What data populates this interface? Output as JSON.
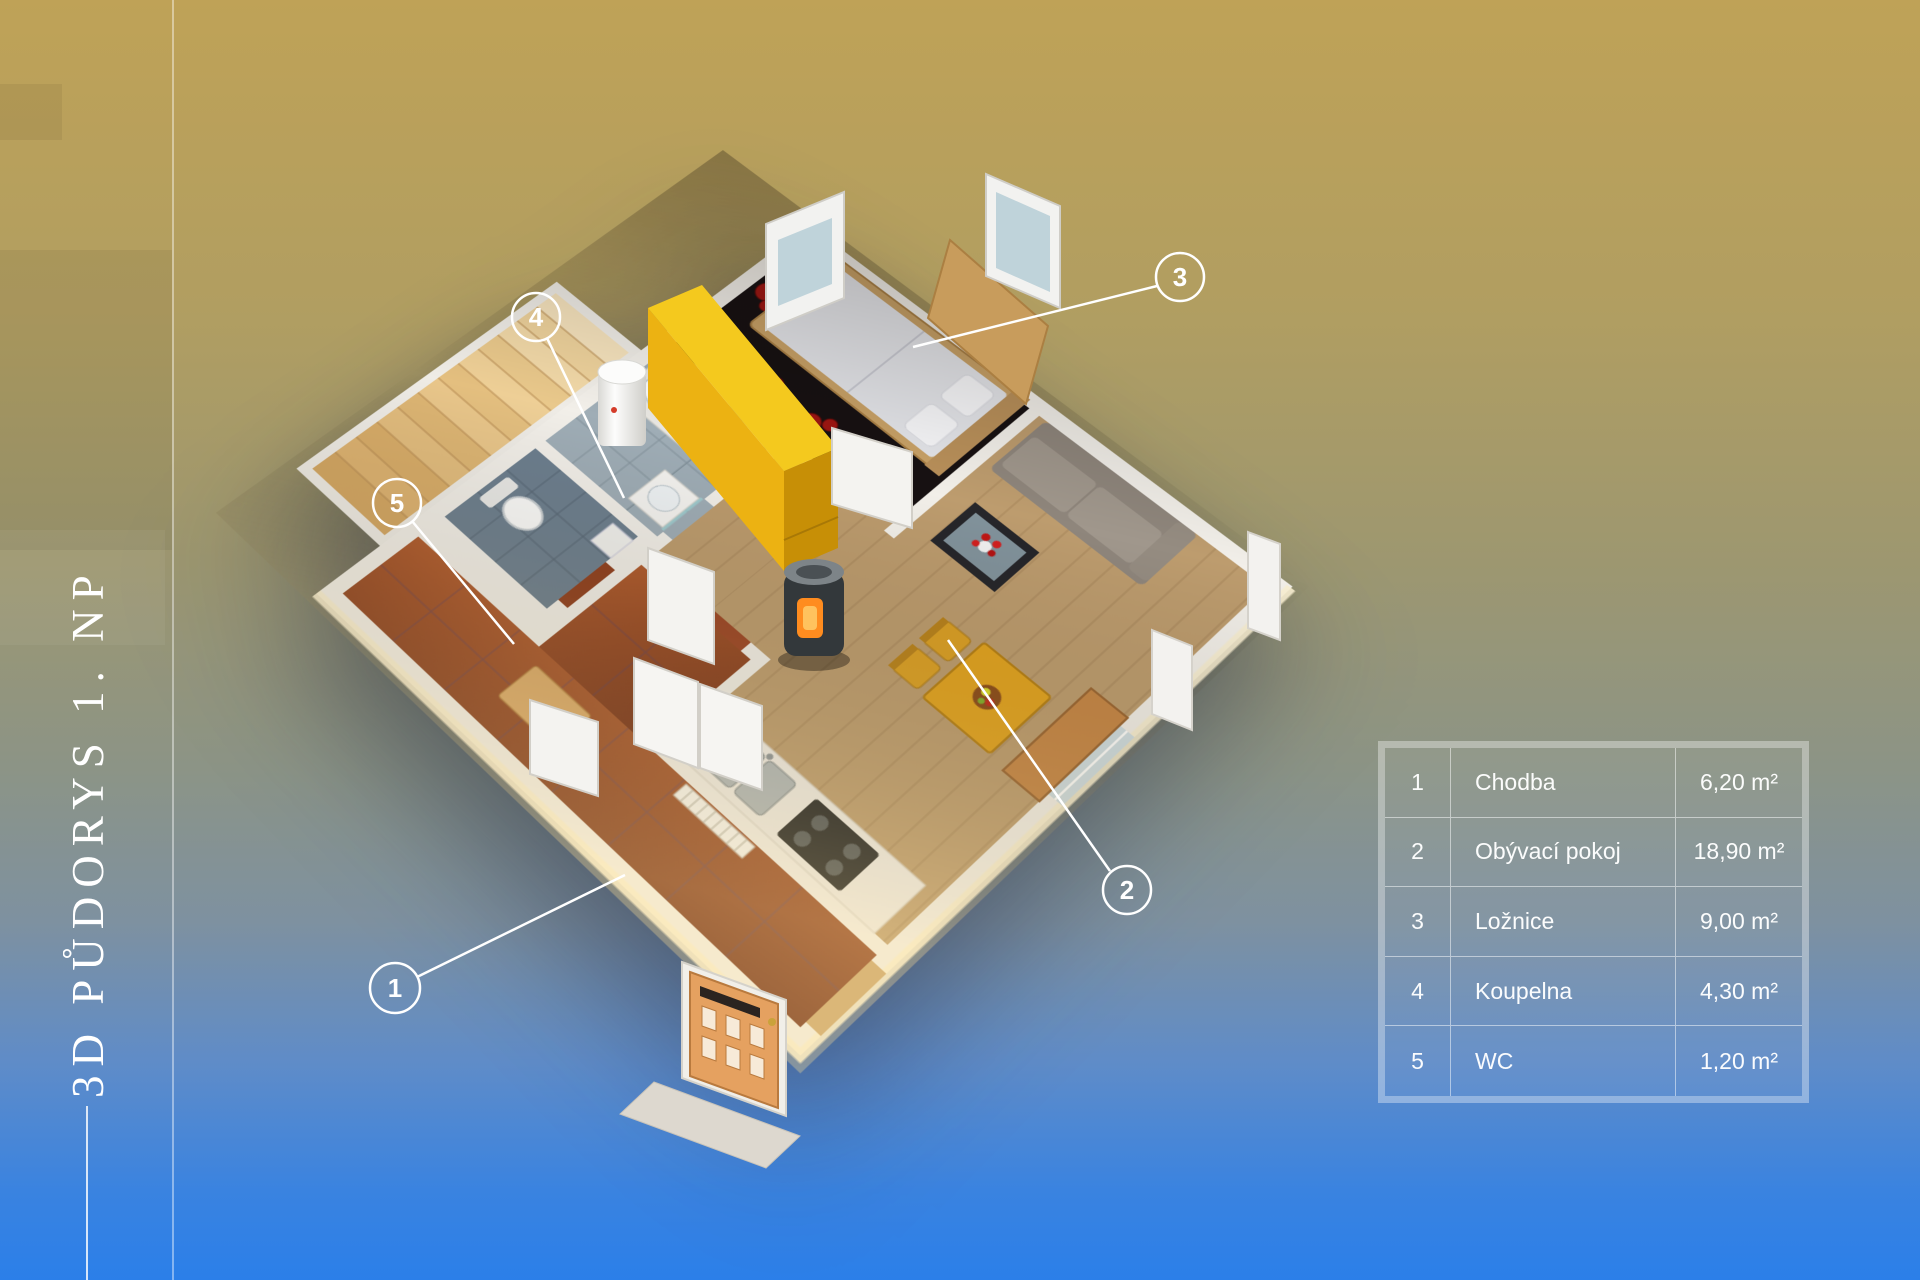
{
  "title": {
    "text": "3D PŮDORYS 1. NP"
  },
  "legend": {
    "rows": [
      {
        "num": "1",
        "name": "Chodba",
        "area": "6,20 m²"
      },
      {
        "num": "2",
        "name": "Obývací pokoj",
        "area": "18,90 m²"
      },
      {
        "num": "3",
        "name": "Ložnice",
        "area": "9,00 m²"
      },
      {
        "num": "4",
        "name": "Koupelna",
        "area": "4,30 m²"
      },
      {
        "num": "5",
        "name": "WC",
        "area": "1,20 m²"
      }
    ]
  },
  "callouts": [
    {
      "num": "1",
      "room": "Chodba"
    },
    {
      "num": "2",
      "room": "Obývací pokoj"
    },
    {
      "num": "3",
      "room": "Ložnice"
    },
    {
      "num": "4",
      "room": "Koupelna"
    },
    {
      "num": "5",
      "room": "WC"
    }
  ],
  "scene": {
    "palette": {
      "background_top": "#bfa257",
      "background_bottom": "#2b7fe9",
      "wall": "#f2efe9",
      "wood_floor": "#bd9c6e",
      "hall_tile": "#8f3e1d",
      "bedroom_floor": "#171112",
      "rug_flower_red": "#9e1612",
      "wardrobe_yellow": "#f0c113",
      "stairs_wood": "#e8c78f",
      "callout_white": "#ffffff"
    }
  }
}
